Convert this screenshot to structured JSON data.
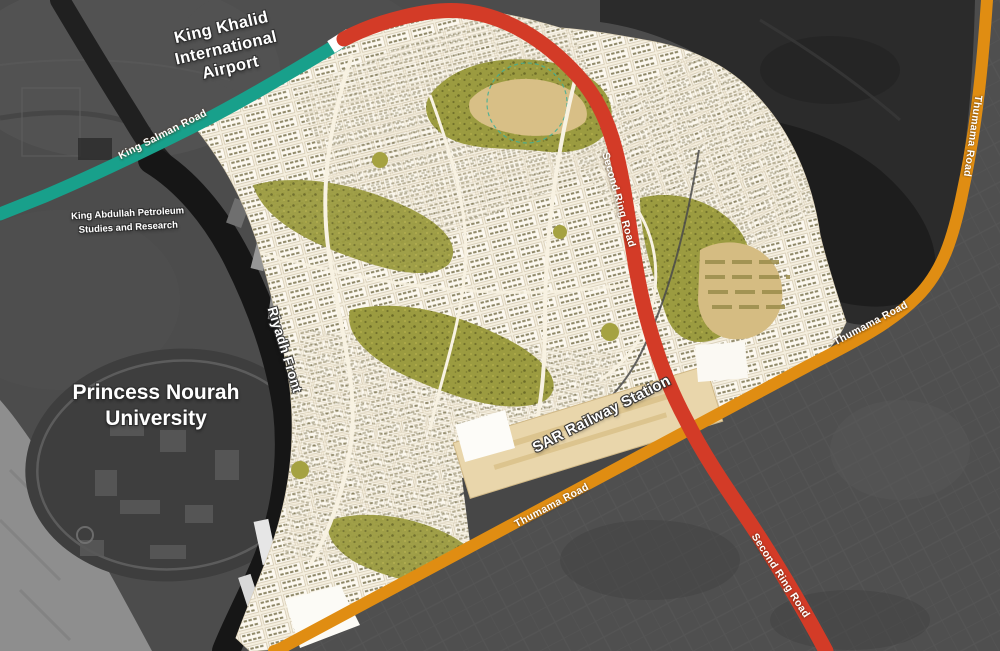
{
  "map": {
    "title_labels": {
      "airport": "King Khalid\nInternational\nAirport",
      "kapsarc": "King Abdullah Petroleum\nStudies and Research",
      "pnu": "Princess Nourah\nUniversity",
      "riyadh_front": "Riyadh Front",
      "sar_station": "SAR Railway Station"
    },
    "roads": {
      "king_salman": {
        "name": "King Salman Road",
        "color": "#18A08B"
      },
      "second_ring": {
        "name": "Second Ring Road",
        "color": "#D33B27"
      },
      "thumama": {
        "name": "Thumama Road",
        "color": "#E08D12"
      }
    },
    "colors": {
      "masterplan_base": "#F2EAD8",
      "park_olive": "#9B9B40",
      "sand_tan": "#D8BF86",
      "satellite_dark": "#4C4C4C",
      "satellite_darkest": "#1B1B1B",
      "riyadh_front_band": "#161616",
      "station_strip": "#E9D6AB",
      "label_text": "#FFFFFF"
    }
  }
}
